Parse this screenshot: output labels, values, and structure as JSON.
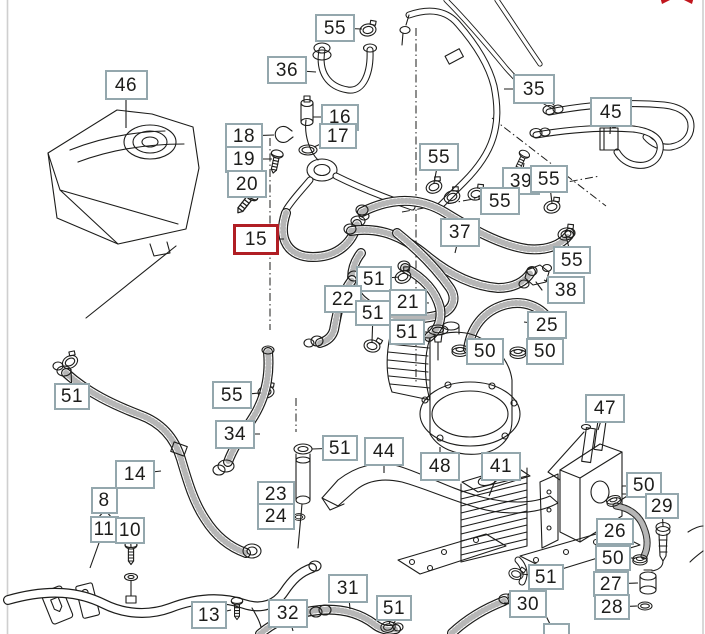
{
  "diagram": {
    "type": "parts-catalog-exploded-view",
    "subject": "engine cooling system — expansion tank, coolant hoses, oil cooler",
    "highlighted_part": "15",
    "callouts": [
      {
        "label": "46",
        "x": 126,
        "y": 85,
        "w": 43,
        "h": 30,
        "leader": [
          126,
          128
        ]
      },
      {
        "label": "55",
        "x": 335,
        "y": 28,
        "w": 40,
        "h": 28,
        "leader": [
          362,
          29
        ]
      },
      {
        "label": "36",
        "x": 287,
        "y": 70,
        "w": 40,
        "h": 28,
        "leader": [
          316,
          72
        ]
      },
      {
        "label": "16",
        "x": 340,
        "y": 117,
        "w": 38,
        "h": 27,
        "leader": [
          313,
          117
        ]
      },
      {
        "label": "17",
        "x": 338,
        "y": 136,
        "w": 38,
        "h": 26,
        "leader": [
          314,
          147
        ]
      },
      {
        "label": "18",
        "x": 244,
        "y": 136,
        "w": 38,
        "h": 27,
        "leader": [
          274,
          135
        ]
      },
      {
        "label": "19",
        "x": 244,
        "y": 159,
        "w": 38,
        "h": 27,
        "leader": [
          272,
          159
        ]
      },
      {
        "label": "20",
        "x": 247,
        "y": 184,
        "w": 40,
        "h": 28,
        "leader": [
          251,
          199
        ]
      },
      {
        "label": "15",
        "x": 256,
        "y": 239,
        "w": 46,
        "h": 31,
        "highlighted": true,
        "leader": [
          284,
          239
        ]
      },
      {
        "label": "35",
        "x": 534,
        "y": 89,
        "w": 42,
        "h": 30,
        "leader": [
          504,
          89
        ]
      },
      {
        "label": "45",
        "x": 611,
        "y": 112,
        "w": 42,
        "h": 30,
        "leader": [
          610,
          134
        ]
      },
      {
        "label": "55",
        "x": 439,
        "y": 157,
        "w": 40,
        "h": 28,
        "leader": [
          434,
          183
        ]
      },
      {
        "label": "39",
        "x": 521,
        "y": 181,
        "w": 38,
        "h": 28,
        "leader": [
          524,
          163
        ]
      },
      {
        "label": "55",
        "x": 549,
        "y": 179,
        "w": 38,
        "h": 28,
        "leader": [
          552,
          203
        ]
      },
      {
        "label": "55",
        "x": 500,
        "y": 201,
        "w": 40,
        "h": 28,
        "leader": [
          478,
          196
        ]
      },
      {
        "label": "37",
        "x": 460,
        "y": 232,
        "w": 40,
        "h": 29,
        "leader": [
          455,
          253
        ]
      },
      {
        "label": "55",
        "x": 572,
        "y": 260,
        "w": 38,
        "h": 28,
        "leader": [
          566,
          236
        ]
      },
      {
        "label": "38",
        "x": 566,
        "y": 290,
        "w": 38,
        "h": 28,
        "leader": [
          544,
          280
        ]
      },
      {
        "label": "51",
        "x": 374,
        "y": 279,
        "w": 36,
        "h": 26,
        "leader": [
          399,
          277
        ]
      },
      {
        "label": "22",
        "x": 343,
        "y": 299,
        "w": 38,
        "h": 28,
        "leader": [
          340,
          322
        ]
      },
      {
        "label": "21",
        "x": 408,
        "y": 302,
        "w": 38,
        "h": 27,
        "leader": [
          429,
          303
        ]
      },
      {
        "label": "51",
        "x": 373,
        "y": 313,
        "w": 36,
        "h": 26,
        "leader": [
          372,
          342
        ]
      },
      {
        "label": "51",
        "x": 407,
        "y": 332,
        "w": 36,
        "h": 26,
        "leader": [
          429,
          332
        ]
      },
      {
        "label": "25",
        "x": 547,
        "y": 325,
        "w": 40,
        "h": 28,
        "leader": [
          524,
          322
        ]
      },
      {
        "label": "50",
        "x": 485,
        "y": 351,
        "w": 38,
        "h": 27,
        "leader": [
          465,
          350
        ]
      },
      {
        "label": "50",
        "x": 545,
        "y": 351,
        "w": 38,
        "h": 27,
        "leader": [
          522,
          351
        ]
      },
      {
        "label": "51",
        "x": 72,
        "y": 396,
        "w": 36,
        "h": 27,
        "leader": [
          71,
          369
        ]
      },
      {
        "label": "55",
        "x": 232,
        "y": 395,
        "w": 40,
        "h": 28,
        "leader": [
          261,
          393
        ]
      },
      {
        "label": "34",
        "x": 235,
        "y": 434,
        "w": 40,
        "h": 29,
        "leader": [
          260,
          434
        ]
      },
      {
        "label": "51",
        "x": 340,
        "y": 448,
        "w": 36,
        "h": 26,
        "leader": [
          312,
          449
        ]
      },
      {
        "label": "14",
        "x": 135,
        "y": 474,
        "w": 40,
        "h": 29,
        "leader": [
          161,
          471
        ]
      },
      {
        "label": "44",
        "x": 384,
        "y": 451,
        "w": 40,
        "h": 29,
        "leader": [
          384,
          473
        ]
      },
      {
        "label": "48",
        "x": 440,
        "y": 466,
        "w": 40,
        "h": 29,
        "leader": [
          440,
          447
        ]
      },
      {
        "label": "23",
        "x": 276,
        "y": 494,
        "w": 38,
        "h": 27,
        "leader": [
          294,
          493
        ]
      },
      {
        "label": "24",
        "x": 276,
        "y": 516,
        "w": 38,
        "h": 27,
        "leader": [
          292,
          516
        ]
      },
      {
        "label": "8",
        "x": 104,
        "y": 500,
        "w": 27,
        "h": 27,
        "leader": [
          105,
          513
        ]
      },
      {
        "label": "11",
        "x": 104,
        "y": 529,
        "w": 29,
        "h": 27,
        "leader": [
          90,
          568
        ]
      },
      {
        "label": "10",
        "x": 130,
        "y": 530,
        "w": 30,
        "h": 27,
        "leader": [
          131,
          547
        ]
      },
      {
        "label": "47",
        "x": 605,
        "y": 408,
        "w": 40,
        "h": 29,
        "leader": [
          598,
          430
        ]
      },
      {
        "label": "41",
        "x": 501,
        "y": 466,
        "w": 40,
        "h": 29,
        "leader": [
          489,
          496
        ]
      },
      {
        "label": "50",
        "x": 644,
        "y": 485,
        "w": 36,
        "h": 26,
        "leader": [
          621,
          500
        ]
      },
      {
        "label": "29",
        "x": 662,
        "y": 506,
        "w": 34,
        "h": 26,
        "leader": [
          663,
          526
        ]
      },
      {
        "label": "26",
        "x": 615,
        "y": 531,
        "w": 38,
        "h": 27,
        "leader": [
          634,
          531
        ]
      },
      {
        "label": "50",
        "x": 613,
        "y": 558,
        "w": 36,
        "h": 26,
        "leader": [
          636,
          558
        ]
      },
      {
        "label": "27",
        "x": 611,
        "y": 584,
        "w": 36,
        "h": 26,
        "leader": [
          638,
          583
        ]
      },
      {
        "label": "28",
        "x": 612,
        "y": 607,
        "w": 36,
        "h": 26,
        "leader": [
          637,
          606
        ]
      },
      {
        "label": "51",
        "x": 546,
        "y": 577,
        "w": 36,
        "h": 26,
        "leader": [
          522,
          574
        ]
      },
      {
        "label": "30",
        "x": 528,
        "y": 604,
        "w": 38,
        "h": 28,
        "leader": [
          504,
          603
        ]
      },
      {
        "label": "13",
        "x": 209,
        "y": 615,
        "w": 36,
        "h": 28,
        "leader": [
          231,
          610
        ]
      },
      {
        "label": "32",
        "x": 288,
        "y": 613,
        "w": 40,
        "h": 29,
        "leader": [
          293,
          631
        ]
      },
      {
        "label": "31",
        "x": 348,
        "y": 588,
        "w": 40,
        "h": 29,
        "leader": [
          350,
          609
        ]
      },
      {
        "label": "51",
        "x": 394,
        "y": 608,
        "w": 36,
        "h": 26,
        "leader": [
          389,
          624
        ]
      },
      {
        "label": "",
        "x": 556,
        "y": 636,
        "w": 27,
        "h": 26,
        "partial": true,
        "leader": [
          545,
          614
        ]
      }
    ]
  },
  "colors": {
    "background": "#ffffff",
    "box_border": "#94a7ad",
    "box_border_highlight": "#b01e24",
    "text": "#1d1d1b",
    "line_art": "#1d1d1b",
    "frame_edge": "#cfcfcf",
    "expand_icon": "#c1161d"
  },
  "icons": {
    "expand": "diagonal-resize-arrows"
  }
}
